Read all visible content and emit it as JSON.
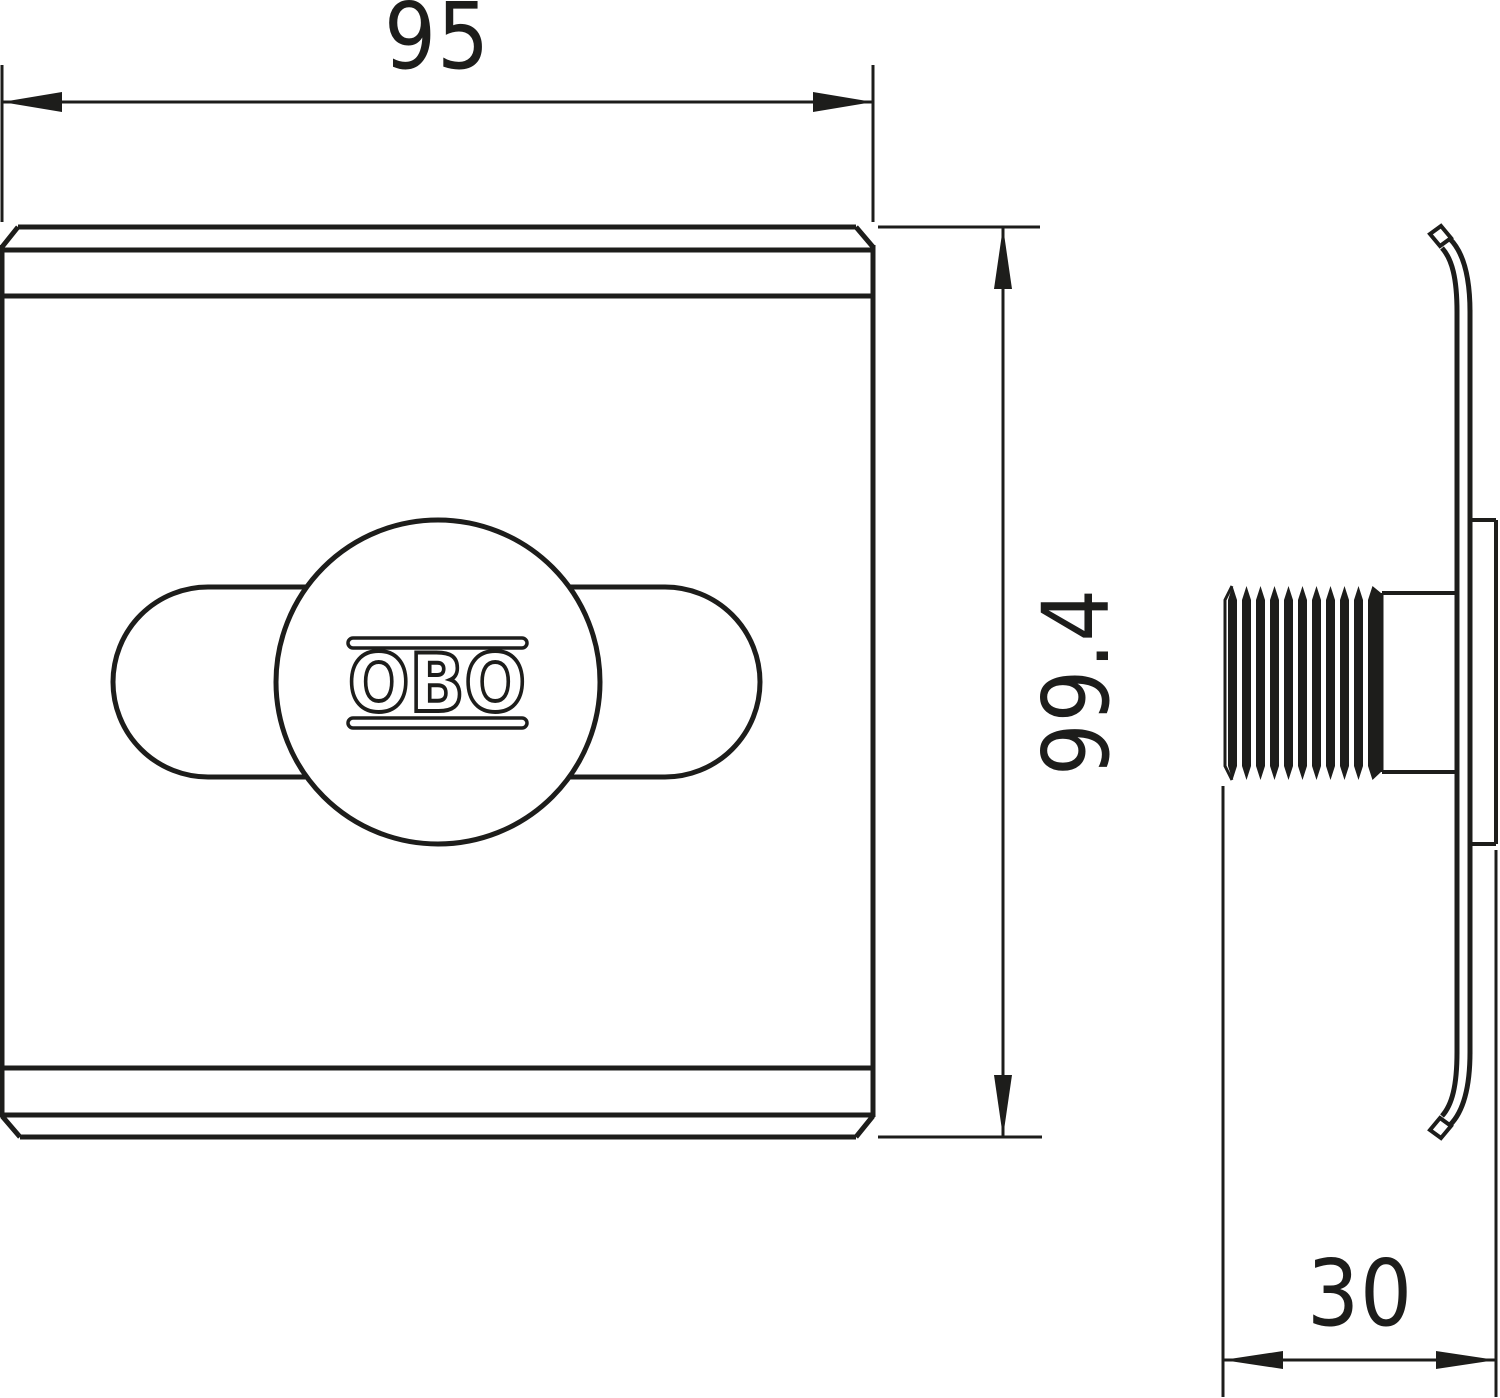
{
  "labels": {
    "dim_width": "95",
    "dim_height": "99.4",
    "dim_depth": "30",
    "logo": "OBO"
  },
  "colors": {
    "line": "#1d1d1b",
    "background": "#ffffff"
  }
}
